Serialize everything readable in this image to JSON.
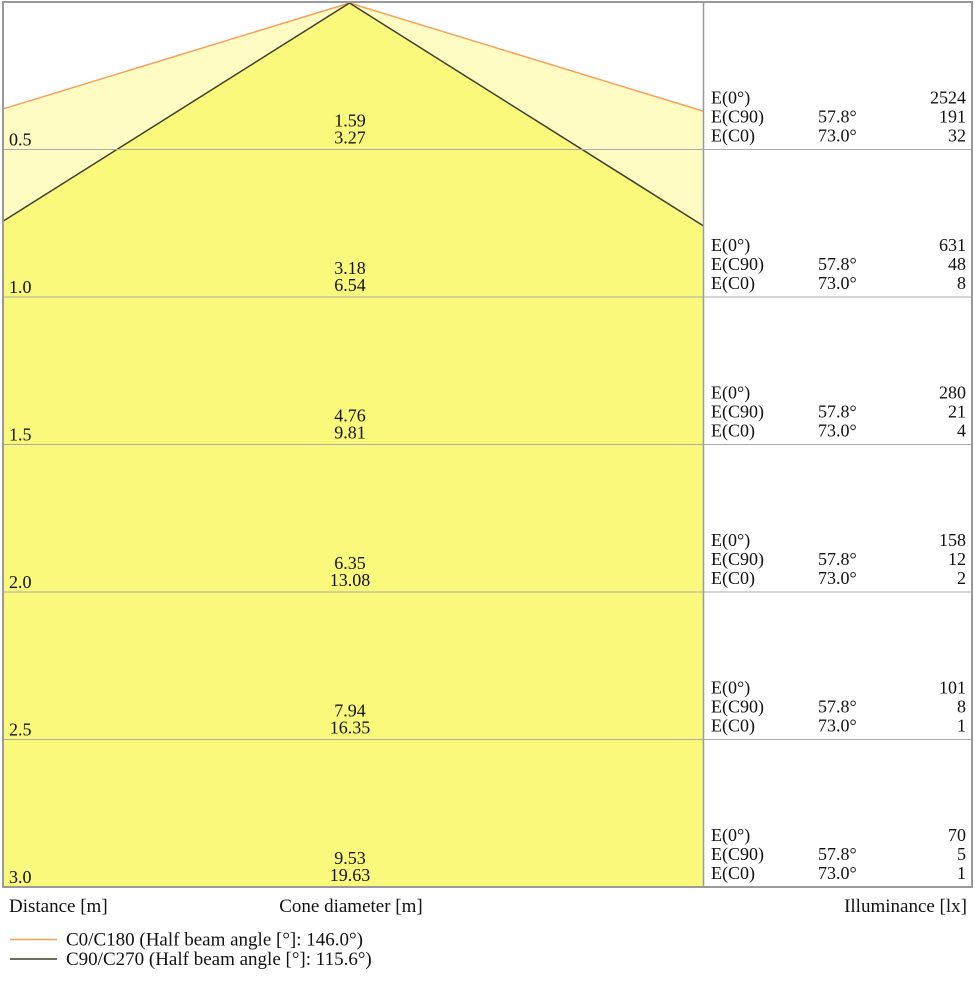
{
  "axis": {
    "distance": "Distance [m]",
    "cone_diameter": "Cone diameter [m]",
    "illuminance": "Illuminance [lx]"
  },
  "legend": {
    "c0": {
      "label": "C0/C180 (Half beam angle [°]: 146.0°)"
    },
    "c90": {
      "label": "C90/C270 (Half beam angle [°]: 115.6°)"
    }
  },
  "colors": {
    "cone_inner": "#FBF97B",
    "cone_outer": "#FEFCC3",
    "c90_line": "#3F3F2A",
    "c0_line": "#F2A159",
    "grid": "#ABABAB",
    "border": "#9A9A9A"
  },
  "rows": [
    {
      "distance": "0.5",
      "cone_c90": "1.59",
      "cone_c0": "3.27",
      "illum": [
        {
          "label": "E(0°)",
          "angle": "",
          "value": "2524"
        },
        {
          "label": "E(C90)",
          "angle": "57.8°",
          "value": "191"
        },
        {
          "label": "E(C0)",
          "angle": "73.0°",
          "value": "32"
        }
      ]
    },
    {
      "distance": "1.0",
      "cone_c90": "3.18",
      "cone_c0": "6.54",
      "illum": [
        {
          "label": "E(0°)",
          "angle": "",
          "value": "631"
        },
        {
          "label": "E(C90)",
          "angle": "57.8°",
          "value": "48"
        },
        {
          "label": "E(C0)",
          "angle": "73.0°",
          "value": "8"
        }
      ]
    },
    {
      "distance": "1.5",
      "cone_c90": "4.76",
      "cone_c0": "9.81",
      "illum": [
        {
          "label": "E(0°)",
          "angle": "",
          "value": "280"
        },
        {
          "label": "E(C90)",
          "angle": "57.8°",
          "value": "21"
        },
        {
          "label": "E(C0)",
          "angle": "73.0°",
          "value": "4"
        }
      ]
    },
    {
      "distance": "2.0",
      "cone_c90": "6.35",
      "cone_c0": "13.08",
      "illum": [
        {
          "label": "E(0°)",
          "angle": "",
          "value": "158"
        },
        {
          "label": "E(C90)",
          "angle": "57.8°",
          "value": "12"
        },
        {
          "label": "E(C0)",
          "angle": "73.0°",
          "value": "2"
        }
      ]
    },
    {
      "distance": "2.5",
      "cone_c90": "7.94",
      "cone_c0": "16.35",
      "illum": [
        {
          "label": "E(0°)",
          "angle": "",
          "value": "101"
        },
        {
          "label": "E(C90)",
          "angle": "57.8°",
          "value": "8"
        },
        {
          "label": "E(C0)",
          "angle": "73.0°",
          "value": "1"
        }
      ]
    },
    {
      "distance": "3.0",
      "cone_c90": "9.53",
      "cone_c0": "19.63",
      "illum": [
        {
          "label": "E(0°)",
          "angle": "",
          "value": "70"
        },
        {
          "label": "E(C90)",
          "angle": "57.8°",
          "value": "5"
        },
        {
          "label": "E(C0)",
          "angle": "73.0°",
          "value": "1"
        }
      ]
    }
  ],
  "chart_data": {
    "type": "area",
    "subtype": "luminaire-light-cone-diagram",
    "title": "",
    "xlabel": "Cone diameter [m]",
    "ylabel_left": "Distance [m]",
    "ylabel_right": "Illuminance [lx]",
    "distances_m": [
      0.5,
      1.0,
      1.5,
      2.0,
      2.5,
      3.0
    ],
    "series": [
      {
        "name": "C0/C180",
        "half_beam_angle_deg": 146.0,
        "cone_half_angle_deg": 73.0,
        "line_color": "#F2A159",
        "fill_color": "#FEFCC3",
        "cone_diameters_m": [
          3.27,
          6.54,
          9.81,
          13.08,
          16.35,
          19.63
        ]
      },
      {
        "name": "C90/C270",
        "half_beam_angle_deg": 115.6,
        "cone_half_angle_deg": 57.8,
        "line_color": "#3F3F2A",
        "fill_color": "#FBF97B",
        "cone_diameters_m": [
          1.59,
          3.18,
          4.76,
          6.35,
          7.94,
          9.53
        ]
      }
    ],
    "illuminance_lx": {
      "E(0°)": [
        2524,
        631,
        280,
        158,
        101,
        70
      ],
      "E(C90)": [
        191,
        48,
        21,
        12,
        8,
        5
      ],
      "E(C0)": [
        32,
        8,
        4,
        2,
        1,
        1
      ],
      "E(C90)_angle": "57.8°",
      "E(C0)_angle": "73.0°"
    },
    "legend_position": "bottom-left",
    "grid": true
  }
}
